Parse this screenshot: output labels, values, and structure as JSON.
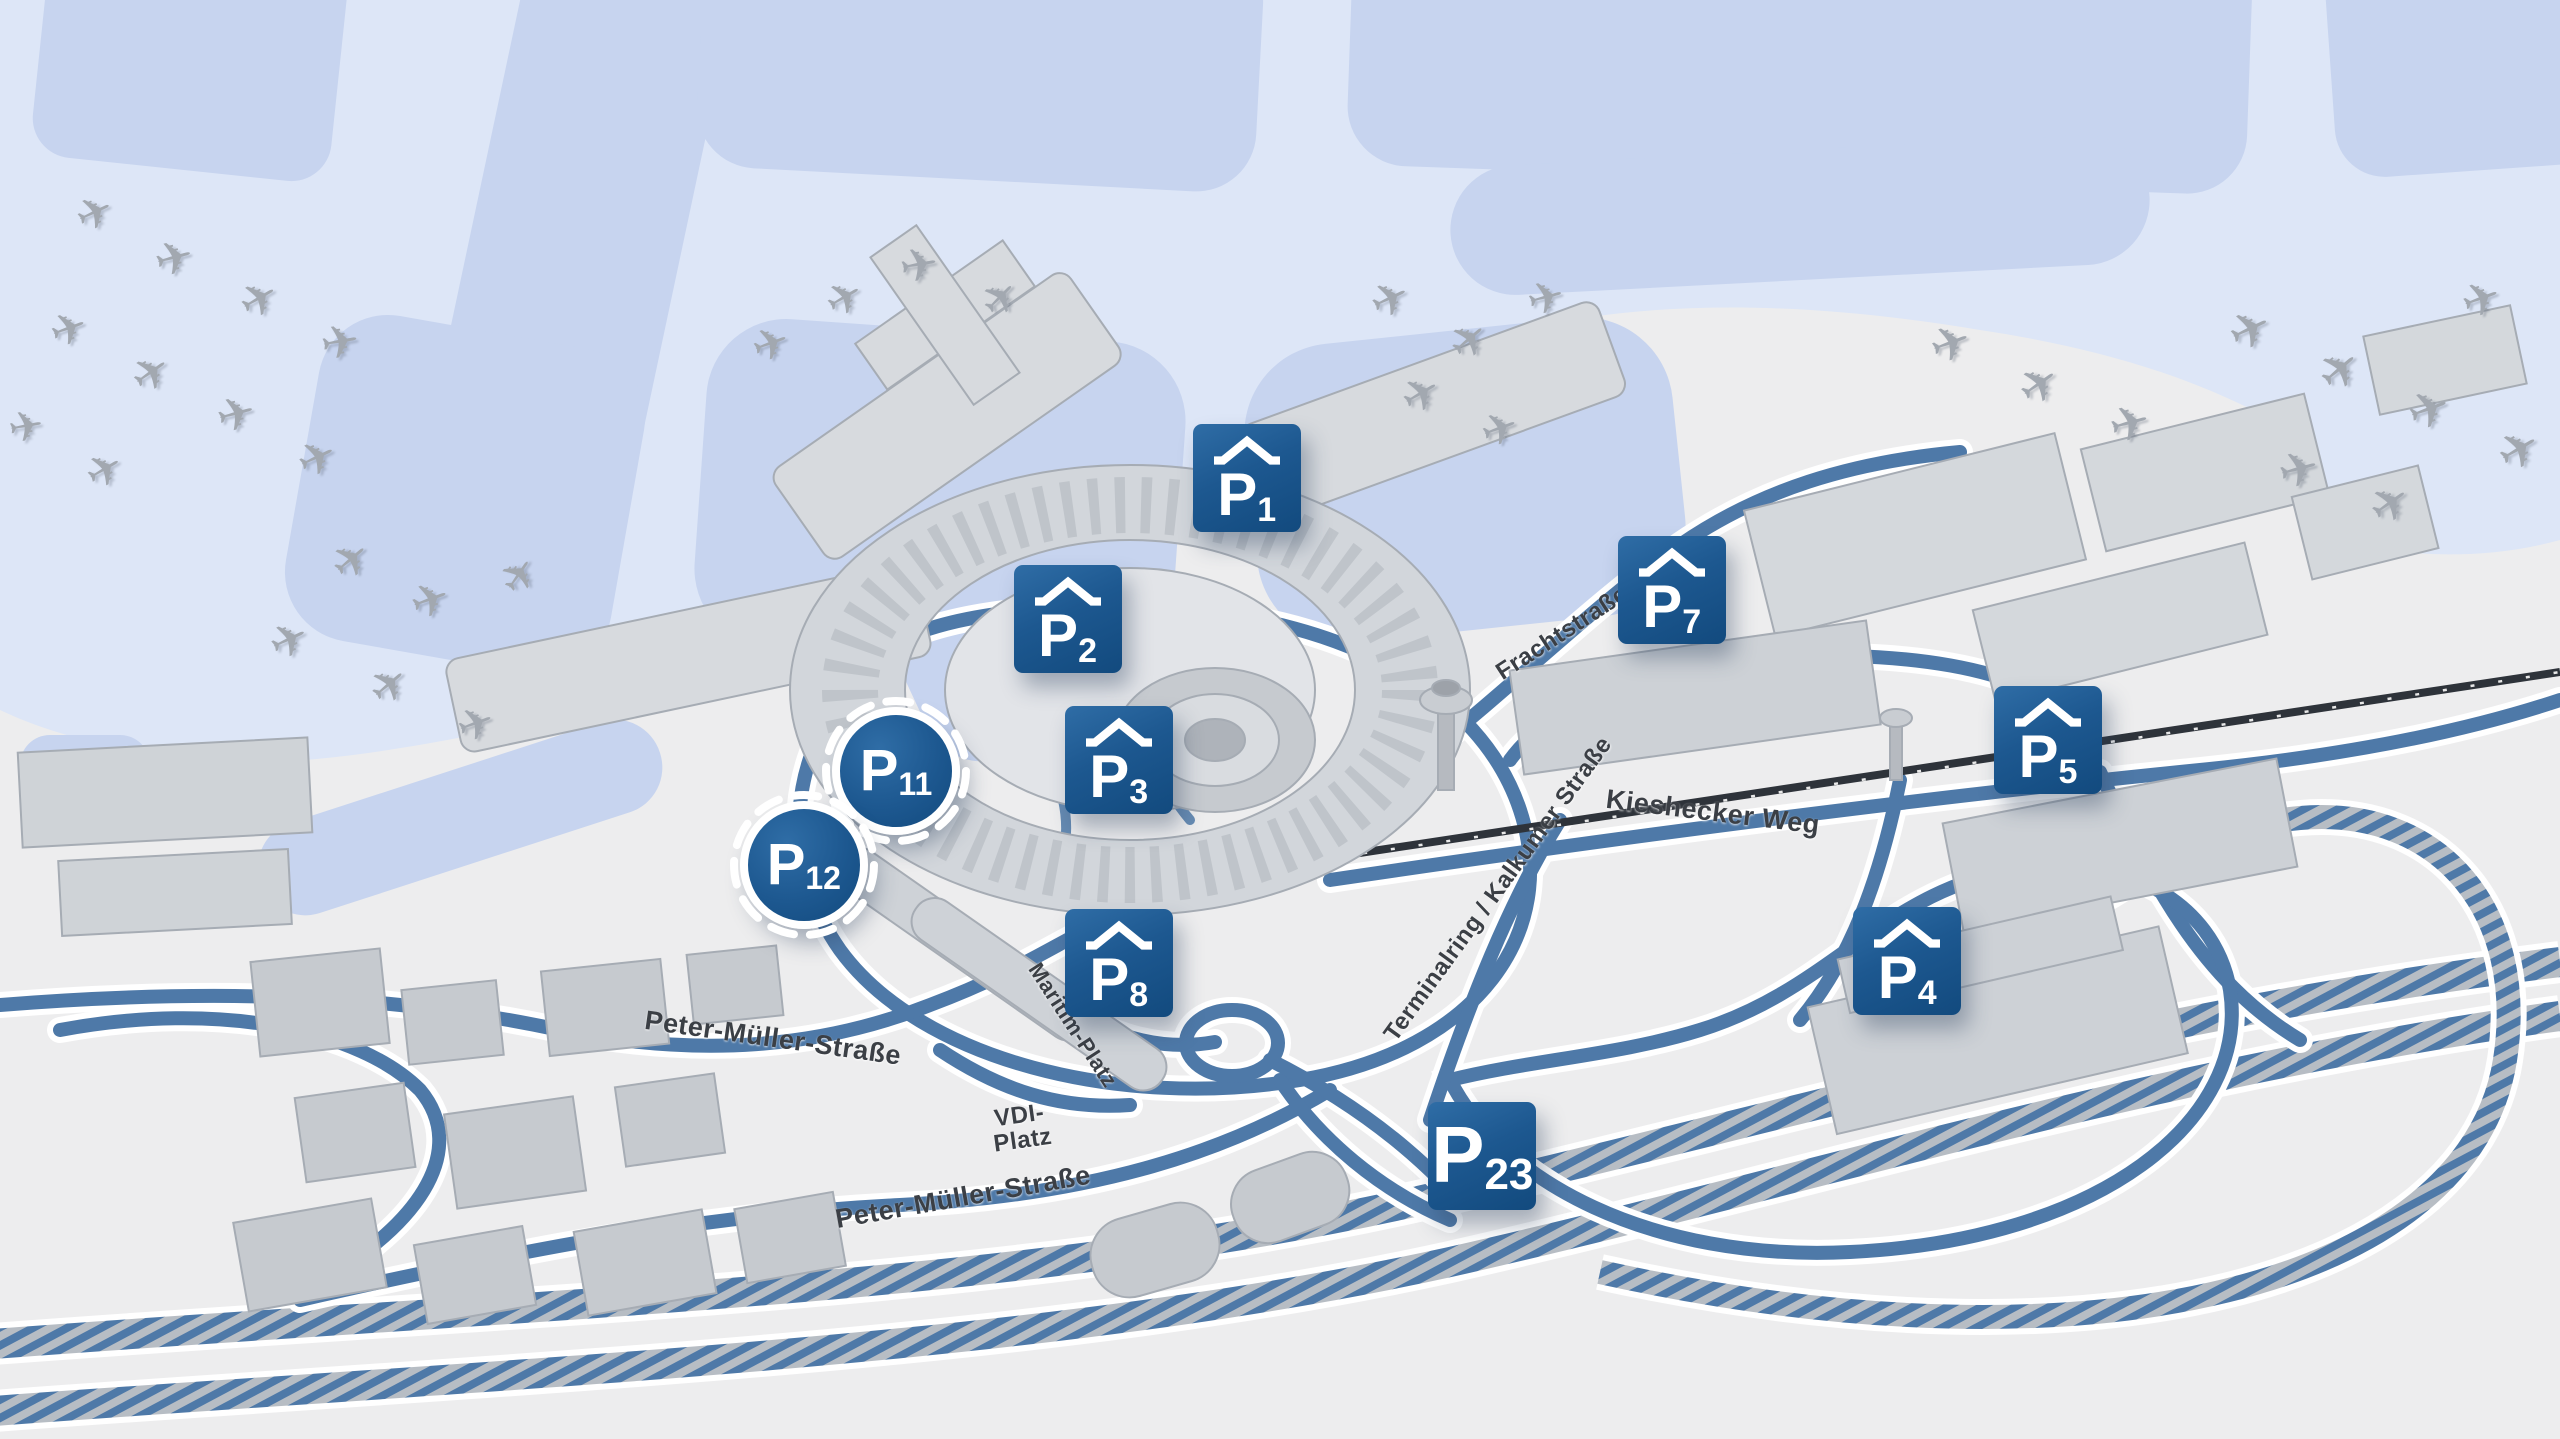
{
  "colors": {
    "marker_blue": "#1d5890",
    "marker_blue_dark": "#124a7e",
    "road_blue": "#4e79a8",
    "airfield_blue": "#dde6f7",
    "airfield_shape_blue": "#c7d4ef",
    "ground_gray": "#ededee",
    "building_gray": "#d4d8dc",
    "railway_dark": "#2e333a",
    "marker_text": "#ffffff",
    "street_text": "#3b3f45"
  },
  "markers": [
    {
      "id": "p1",
      "p": "P",
      "num": "1",
      "type": "covered",
      "x": 48.7,
      "y": 33.2
    },
    {
      "id": "p2",
      "p": "P",
      "num": "2",
      "type": "covered",
      "x": 41.7,
      "y": 43.0
    },
    {
      "id": "p3",
      "p": "P",
      "num": "3",
      "type": "covered",
      "x": 43.7,
      "y": 52.8
    },
    {
      "id": "p7",
      "p": "P",
      "num": "7",
      "type": "covered",
      "x": 65.3,
      "y": 41.0
    },
    {
      "id": "p5",
      "p": "P",
      "num": "5",
      "type": "covered",
      "x": 80.0,
      "y": 51.4
    },
    {
      "id": "p4",
      "p": "P",
      "num": "4",
      "type": "covered",
      "x": 74.5,
      "y": 66.8
    },
    {
      "id": "p8",
      "p": "P",
      "num": "8",
      "type": "covered",
      "x": 43.7,
      "y": 66.9
    },
    {
      "id": "p23",
      "p": "P",
      "num": "23",
      "type": "plain",
      "x": 57.9,
      "y": 80.3
    },
    {
      "id": "p11",
      "p": "P",
      "num": "11",
      "type": "circle",
      "x": 35.0,
      "y": 53.6
    },
    {
      "id": "p12",
      "p": "P",
      "num": "12",
      "type": "circle",
      "x": 31.4,
      "y": 60.1
    }
  ],
  "street_labels": [
    {
      "text": "Peter-Müller-Straße",
      "x": 30.2,
      "y": 72.1,
      "rot": 8,
      "size": 27
    },
    {
      "text": "Peter-Müller-Straße",
      "x": 37.6,
      "y": 83.2,
      "rot": -10,
      "size": 27
    },
    {
      "text": "VDI-\nPlatz",
      "x": 39.9,
      "y": 78.4,
      "rot": -8,
      "size": 24
    },
    {
      "text": "Kieshecker Weg",
      "x": 66.9,
      "y": 56.4,
      "rot": 7,
      "size": 27
    },
    {
      "text": "Frachtstraße",
      "x": 61.0,
      "y": 44.0,
      "rot": -33,
      "size": 24
    },
    {
      "text": "Terminalring / Kalkumer Straße",
      "x": 58.5,
      "y": 61.8,
      "rot": -54,
      "size": 24
    },
    {
      "text": "Maritim-Platz",
      "x": 41.9,
      "y": 71.2,
      "rot": 57,
      "size": 22
    }
  ],
  "planes": [
    {
      "x": 3.7,
      "y": 14.9,
      "r": -25,
      "s": 44
    },
    {
      "x": 6.8,
      "y": 17.9,
      "r": -15,
      "s": 46
    },
    {
      "x": 10.1,
      "y": 20.8,
      "r": -30,
      "s": 46
    },
    {
      "x": 13.3,
      "y": 23.8,
      "r": -10,
      "s": 46
    },
    {
      "x": 2.7,
      "y": 22.9,
      "r": -20,
      "s": 44
    },
    {
      "x": 5.9,
      "y": 25.9,
      "r": -35,
      "s": 46
    },
    {
      "x": 9.2,
      "y": 28.8,
      "r": -15,
      "s": 46
    },
    {
      "x": 12.4,
      "y": 31.8,
      "r": -25,
      "s": 46
    },
    {
      "x": 1.0,
      "y": 29.7,
      "r": -10,
      "s": 42
    },
    {
      "x": 4.1,
      "y": 32.7,
      "r": -30,
      "s": 44
    },
    {
      "x": 13.7,
      "y": 38.9,
      "r": -40,
      "s": 46
    },
    {
      "x": 16.8,
      "y": 41.7,
      "r": -20,
      "s": 46
    },
    {
      "x": 20.3,
      "y": 40.0,
      "r": -55,
      "s": 44
    },
    {
      "x": 11.3,
      "y": 44.5,
      "r": -25,
      "s": 46
    },
    {
      "x": 15.2,
      "y": 47.6,
      "r": -40,
      "s": 46
    },
    {
      "x": 18.6,
      "y": 50.4,
      "r": -20,
      "s": 44
    },
    {
      "x": 33.0,
      "y": 20.8,
      "r": -30,
      "s": 44
    },
    {
      "x": 35.9,
      "y": 18.4,
      "r": -10,
      "s": 46
    },
    {
      "x": 39.1,
      "y": 20.8,
      "r": -45,
      "s": 44
    },
    {
      "x": 30.1,
      "y": 24.0,
      "r": -20,
      "s": 44
    },
    {
      "x": 54.3,
      "y": 20.8,
      "r": -25,
      "s": 46
    },
    {
      "x": 57.4,
      "y": 23.6,
      "r": -40,
      "s": 46
    },
    {
      "x": 60.4,
      "y": 20.8,
      "r": -15,
      "s": 44
    },
    {
      "x": 55.5,
      "y": 27.4,
      "r": -30,
      "s": 46
    },
    {
      "x": 58.6,
      "y": 29.9,
      "r": -20,
      "s": 44
    },
    {
      "x": 76.2,
      "y": 24.0,
      "r": -20,
      "s": 48
    },
    {
      "x": 79.7,
      "y": 26.8,
      "r": -35,
      "s": 48
    },
    {
      "x": 83.2,
      "y": 29.5,
      "r": -15,
      "s": 48
    },
    {
      "x": 87.9,
      "y": 22.9,
      "r": -25,
      "s": 50
    },
    {
      "x": 91.4,
      "y": 25.7,
      "r": -40,
      "s": 50
    },
    {
      "x": 94.9,
      "y": 28.5,
      "r": -20,
      "s": 50
    },
    {
      "x": 98.4,
      "y": 31.3,
      "r": -30,
      "s": 50
    },
    {
      "x": 89.8,
      "y": 32.7,
      "r": -15,
      "s": 48
    },
    {
      "x": 93.4,
      "y": 35.1,
      "r": -35,
      "s": 48
    },
    {
      "x": 96.9,
      "y": 20.8,
      "r": -20,
      "s": 46
    }
  ],
  "plane_glyph": "✈"
}
